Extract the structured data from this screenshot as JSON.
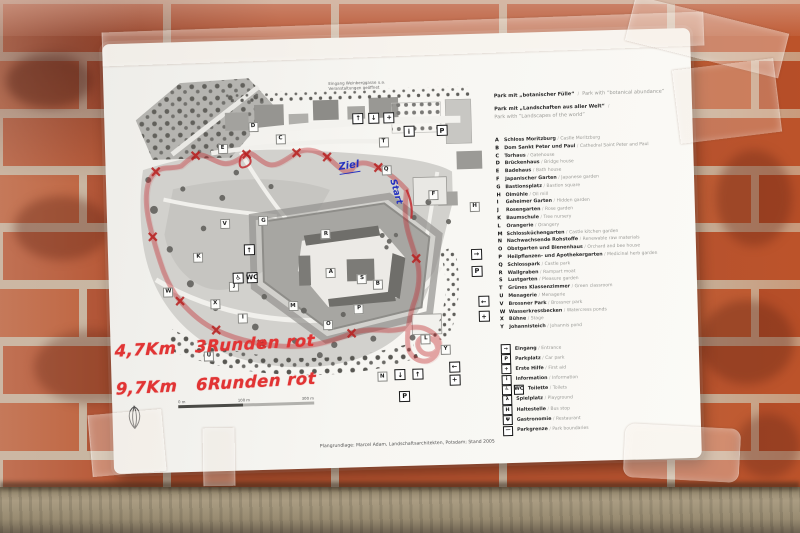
{
  "paper": {
    "credit": "Plangrundlage: Marcel Adam, Landschaftsarchitekten, Potsdam; Stand 2005"
  },
  "note": {
    "line1": "Eingang Weinberggasse u.a.",
    "line2": "Veranstaltungen geöffnet"
  },
  "handwriting": {
    "line1": "4,7Km   3Runden rot",
    "line2": "9,7Km   6Runden rot",
    "color": "#e13434"
  },
  "map": {
    "labels": {
      "ziel": "Ziel",
      "start": "Start"
    },
    "scale": {
      "l0": "0 m",
      "l1": "100 m",
      "l2": "300 m"
    },
    "letters": [
      "A",
      "B",
      "C",
      "D",
      "E",
      "F",
      "G",
      "H",
      "I",
      "J",
      "K",
      "L",
      "M",
      "N",
      "O",
      "P",
      "Q",
      "R",
      "S",
      "T",
      "U",
      "V",
      "W",
      "X",
      "Y"
    ],
    "icon_glyphs": [
      "↑",
      "↓",
      "+",
      "i",
      "P",
      "→",
      "P",
      "←",
      "+",
      "←",
      "+",
      "↓",
      "↑",
      "P",
      "↑",
      "♿",
      "WC"
    ],
    "route_color": "#c22126",
    "label_color": "#2431bf"
  },
  "legend": {
    "sep": "/",
    "header1": {
      "de": "Park mit „botanischer Fülle“",
      "en": "Park with “botanical abundance”"
    },
    "header2": {
      "de": "Park mit „Landschaften aus aller Welt“",
      "en": "Park with “Landscapes of the world”"
    },
    "entries": [
      {
        "key": "A",
        "de": "Schloss Moritzburg",
        "en": "Castle Moritzburg"
      },
      {
        "key": "B",
        "de": "Dom Sankt Peter und Paul",
        "en": "Cathedral Saint Peter and Paul"
      },
      {
        "key": "C",
        "de": "Torhaus",
        "en": "Gatehouse"
      },
      {
        "key": "D",
        "de": "Brückenhaus",
        "en": "Bridge house"
      },
      {
        "key": "E",
        "de": "Badehaus",
        "en": "Bath house"
      },
      {
        "key": "F",
        "de": "Japanischer Garten",
        "en": "Japanese garden"
      },
      {
        "key": "G",
        "de": "Bastionsplatz",
        "en": "Bastion square"
      },
      {
        "key": "H",
        "de": "Ölmühle",
        "en": "Oil mill"
      },
      {
        "key": "I",
        "de": "Geheimer Garten",
        "en": "Hidden garden"
      },
      {
        "key": "J",
        "de": "Rosengarten",
        "en": "Rose garden"
      },
      {
        "key": "K",
        "de": "Baumschule",
        "en": "Tree nursery"
      },
      {
        "key": "L",
        "de": "Orangerie",
        "en": "Orangery"
      },
      {
        "key": "M",
        "de": "Schlossküchengarten",
        "en": "Castle kitchen garden"
      },
      {
        "key": "N",
        "de": "Nachwachsende Rohstoffe",
        "en": "Renewable raw materials"
      },
      {
        "key": "O",
        "de": "Obstgarten und Bienenhaus",
        "en": "Orchard and bee house"
      },
      {
        "key": "P",
        "de": "Heilpflanzen- und Apothekergarten",
        "en": "Medicinal herb garden"
      },
      {
        "key": "Q",
        "de": "Schlosspark",
        "en": "Castle park"
      },
      {
        "key": "R",
        "de": "Wallgraben",
        "en": "Rampart moat"
      },
      {
        "key": "S",
        "de": "Lustgarten",
        "en": "Pleasure garden"
      },
      {
        "key": "T",
        "de": "Grünes Klassenzimmer",
        "en": "Green classroom"
      },
      {
        "key": "U",
        "de": "Menagerie",
        "en": "Menagerie"
      },
      {
        "key": "V",
        "de": "Brossner Park",
        "en": "Brossner park"
      },
      {
        "key": "W",
        "de": "Wasserkressbecken",
        "en": "Watercress ponds"
      },
      {
        "key": "X",
        "de": "Bühne",
        "en": "Stage"
      },
      {
        "key": "Y",
        "de": "Johannisteich",
        "en": "Johannis pond"
      }
    ],
    "icons": [
      {
        "glyph": "→",
        "de": "Eingang",
        "en": "Entrance"
      },
      {
        "glyph": "P",
        "de": "Parkplatz",
        "en": "Car park"
      },
      {
        "glyph": "+",
        "de": "Erste Hilfe",
        "en": "First aid"
      },
      {
        "glyph": "i",
        "de": "Information",
        "en": "Information"
      },
      {
        "glyph": "♿",
        "glyph2": "WC",
        "de": "Toilette",
        "en": "Toilets"
      },
      {
        "glyph": "λ",
        "de": "Spielplatz",
        "en": "Playground"
      },
      {
        "glyph": "H",
        "de": "Haltestelle",
        "en": "Bus stop"
      },
      {
        "glyph": "Ψ",
        "de": "Gastronomie",
        "en": "Restaurant"
      },
      {
        "glyph": "—",
        "de": "Parkgrenze",
        "en": "Park boundaries"
      }
    ]
  }
}
